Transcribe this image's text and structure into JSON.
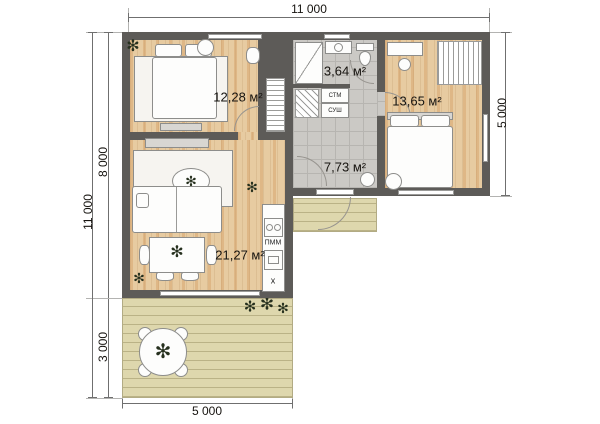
{
  "dimensions": {
    "top": "11 000",
    "left_outer": "11 000",
    "left_upper": "8 000",
    "left_lower": "3 000",
    "right": "5 000",
    "bottom": "5 000"
  },
  "rooms": {
    "bedroom1": {
      "area": "12,28 м²"
    },
    "bathroom": {
      "area": "3,64 м²"
    },
    "bedroom2": {
      "area": "13,65 м²"
    },
    "hall": {
      "area": "7,73 м²"
    },
    "living_room": {
      "area": "21,27 м²"
    }
  },
  "appliances": {
    "washer": "СТМ",
    "dryer": "СУШ",
    "dishwasher": "ПММ",
    "sink_mark": "х"
  },
  "icons": {
    "plant": "✻"
  },
  "colors": {
    "wall": "#5d5b58",
    "wood": "#e7cba1",
    "wood_accent": "#cf9254",
    "tile": "#cbc9c5",
    "deck": "#ded7ad",
    "outline": "#8d8d8b"
  }
}
